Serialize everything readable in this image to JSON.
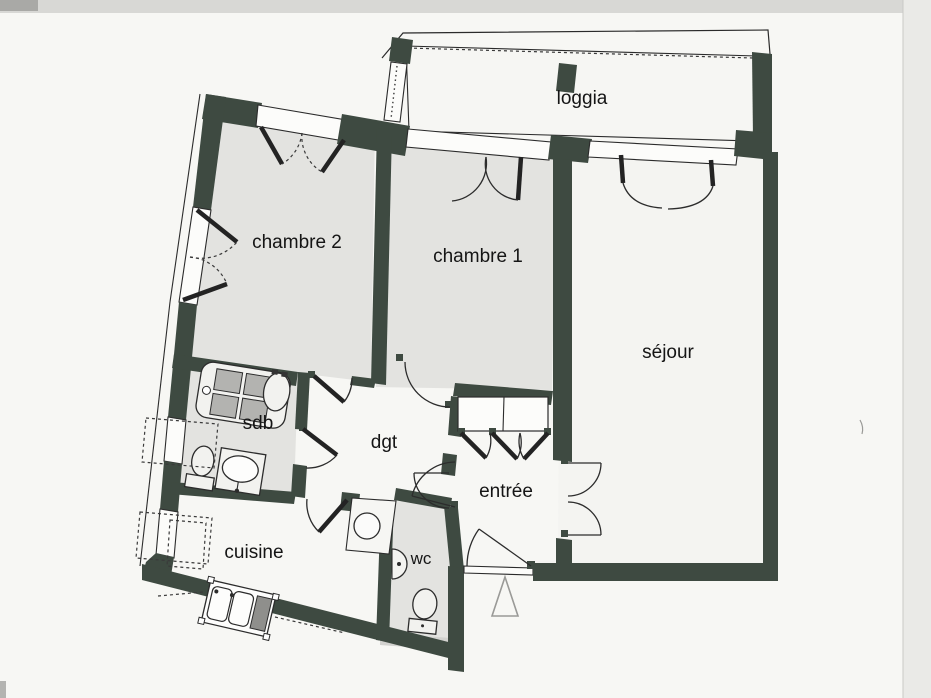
{
  "rooms": [
    {
      "id": "loggia",
      "label": "loggia"
    },
    {
      "id": "chambre2",
      "label": "chambre 2"
    },
    {
      "id": "chambre1",
      "label": "chambre 1"
    },
    {
      "id": "sejour",
      "label": "séjour"
    },
    {
      "id": "sdb",
      "label": "sdb"
    },
    {
      "id": "dgt",
      "label": "dgt"
    },
    {
      "id": "entree",
      "label": "entrée"
    },
    {
      "id": "cuisine",
      "label": "cuisine"
    },
    {
      "id": "wc",
      "label": "wc"
    }
  ],
  "fixtures": [
    "bathtub",
    "bidet",
    "toilet",
    "washbasin",
    "kitchen-sink",
    "wall-basin",
    "wc-toilet",
    "water-heater",
    "wardrobe",
    "entrance-arrow"
  ],
  "colors": {
    "paper": "#f7f7f4",
    "wall": "#3e4a41",
    "room": "#e3e3e0",
    "line": "#2b2b2b",
    "fixture": "#b3b3b0"
  }
}
